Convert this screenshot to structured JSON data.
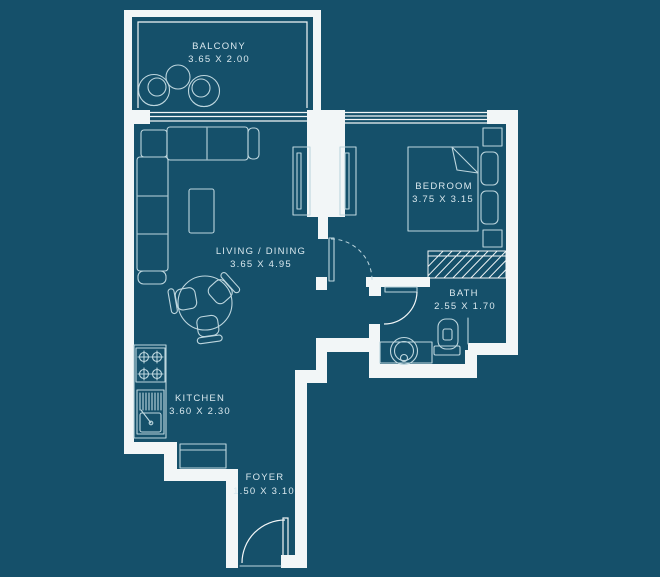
{
  "colors": {
    "background": "#15506a",
    "walls": "#f2f6f7",
    "furniture_lines": "#bdd6de",
    "label_text": "#d9e8ee"
  },
  "floor_plan": {
    "rooms": [
      {
        "id": "balcony",
        "name": "BALCONY",
        "dimensions": "3.65 X 2.00"
      },
      {
        "id": "living_dining",
        "name": "LIVING / DINING",
        "dimensions": "3.65 X 4.95"
      },
      {
        "id": "bedroom",
        "name": "BEDROOM",
        "dimensions": "3.75 X 3.15"
      },
      {
        "id": "bath",
        "name": "BATH",
        "dimensions": "2.55 X 1.70"
      },
      {
        "id": "kitchen",
        "name": "KITCHEN",
        "dimensions": "3.60 X 2.30"
      },
      {
        "id": "foyer",
        "name": "FOYER",
        "dimensions": "1.50 X 3.10"
      }
    ]
  }
}
